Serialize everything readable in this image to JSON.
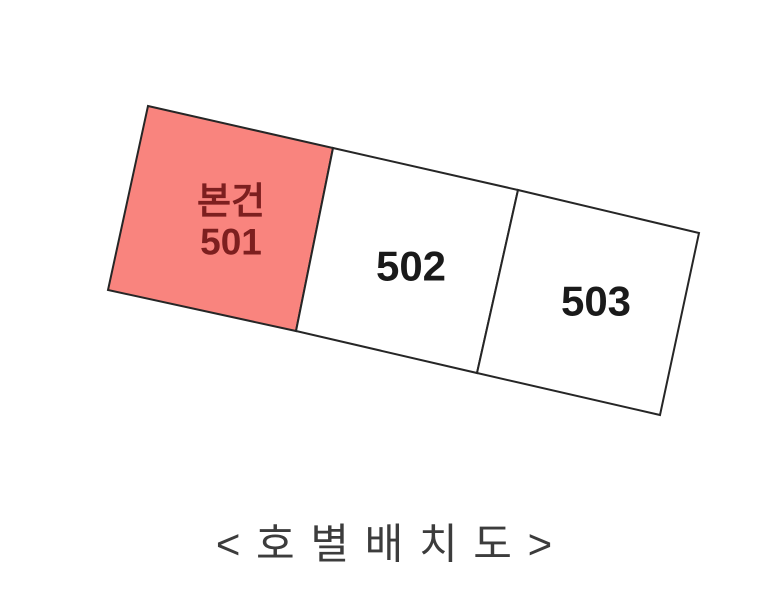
{
  "diagram": {
    "background_color": "#ffffff",
    "outline_color": "#262626",
    "units": [
      {
        "id": "501",
        "name": "본건",
        "number": "501",
        "fill": "#f9847e",
        "text_color": "#7d1f1f",
        "highlighted": true,
        "points": "148,106 333,148 296,331 108,290"
      },
      {
        "id": "502",
        "name": "",
        "number": "502",
        "fill": "#ffffff",
        "text_color": "#1a1a1a",
        "highlighted": false,
        "points": "333,148 518,190 477,373 296,331"
      },
      {
        "id": "503",
        "name": "",
        "number": "503",
        "fill": "#ffffff",
        "text_color": "#1a1a1a",
        "highlighted": false,
        "points": "518,190 699,233 660,415 477,373"
      }
    ],
    "caption": "< 호 별 배 치 도 >"
  }
}
